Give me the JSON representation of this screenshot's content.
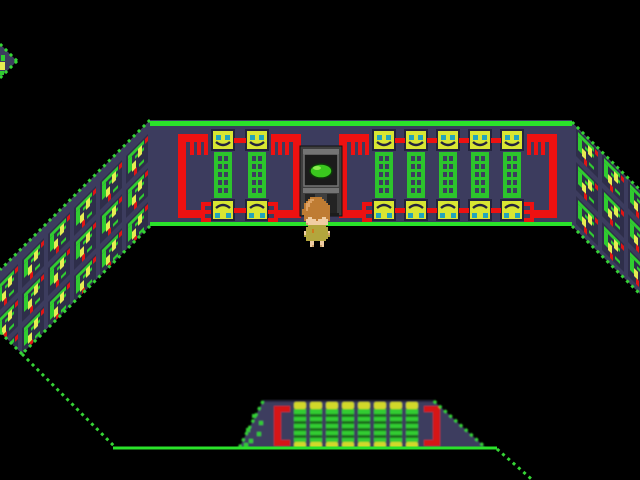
{
  "app": {
    "type": "game-screenshot",
    "description": "Top-down pixel RPG room: dark void floor, navy walls decorated with yellow smiley-face panels, green ladder grids and red pipe ornaments, a grey monitor-door with a green blob, and a brown-haired player character in an olive tunic"
  },
  "palette": {
    "background": "#000000",
    "wall": "#3c3c5e",
    "wall_shadow": "#2e2e4a",
    "border_dots": "#35d435",
    "line_green": "#2ae22a",
    "face_yellow": "#d8e632",
    "face_outline": "#23233d",
    "eye_cyan": "#23a4bc",
    "ladder_green": "#2cc42c",
    "pipe_red": "#ee1111",
    "motif_green": "#30cc30",
    "motif_yellow": "#e6ec52",
    "motif_red": "#e01414",
    "door_frame": "#3f3f3f",
    "door_frame_light": "#747474",
    "door_screen": "#1b1b1b",
    "door_slat": "#232323",
    "blob_green": "#3ac81e",
    "blob_light": "#8cec50",
    "blob_outline": "#0c3c08",
    "col_green": "#30cc30",
    "col_stripe": "#1d6e1d",
    "col_yellow": "#d2d82a",
    "bracket_red": "#d61616"
  },
  "scene": {
    "back_wall": {
      "left_block_face_columns": 2,
      "right_block_face_columns": 5,
      "pipe_count": 4,
      "top_face_style": "smiley",
      "bottom_face_style": "inverted-smiley"
    },
    "door": {
      "label": "monitor-door",
      "screen_icon": "green-blob"
    },
    "south_wall": {
      "green_column_count": 8,
      "red_bracket_count": 2
    },
    "left_wall": {
      "motif_cols": 7,
      "motif_rows": 4
    },
    "right_wall": {
      "motif_cols": 3,
      "motif_rows": 4
    },
    "player": {
      "label": "player-character",
      "sprite": {
        "legend": {
          "h": "#bf7c33",
          "H": "#9a5f24",
          "L": "#dea263",
          "s": "#f0cda2",
          "S": "#d4a173",
          "o": "#b3a63d",
          "O": "#8f8530",
          "r": "#cf7a1e",
          "f": "#caa06a"
        },
        "rows": [
          "....hhhhhh......",
          "...hLLhhhhh.....",
          "..hLLhhhhhhh....",
          ".hLLhhhhhhhhh...",
          ".hLLhhhhhhhhhh..",
          ".hLhhhhhhhhhhh..",
          "hhLhhhhhhhhhhh..",
          "hhhhhhhhhhhhhh..",
          "hhhhhhhhhhhhhh..",
          ".hhhhhhhhhhhhh..",
          ".hhsshhhhhsshh..",
          ".hssssshsssssh..",
          "..sssssssssss...",
          "..Sssssssssss...",
          "...ooooooooo....",
          "..ooooooooooo...",
          "..ooorooooooo...",
          ".sooorooooooos..",
          ".soooooooooooS..",
          ".ooooooooooooo..",
          "..ooooooooooo...",
          "..oooooooooo....",
          "....ss...ss.....",
          "....ss...ss.....",
          "....sf...fs....."
        ]
      }
    }
  }
}
